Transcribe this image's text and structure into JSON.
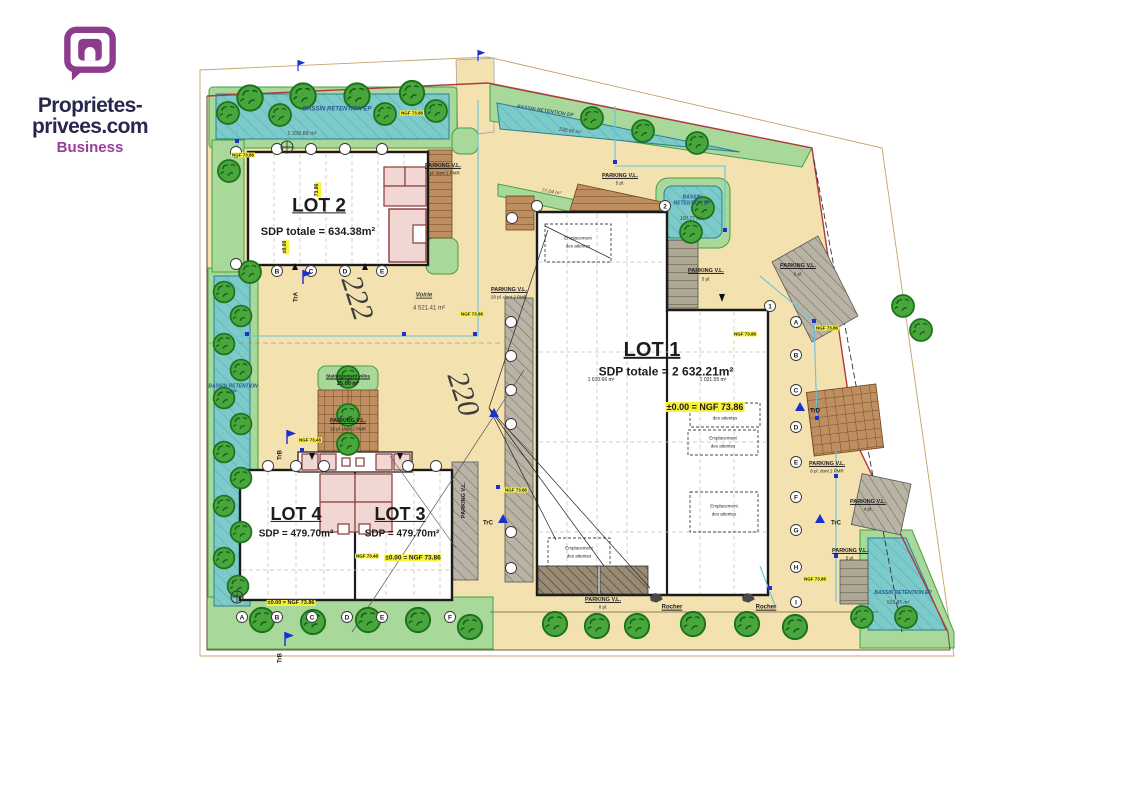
{
  "logo": {
    "line1": "Proprietes-",
    "line2": "privees.com",
    "line3": "Business"
  },
  "site": {
    "lot1_title": "LOT 1",
    "lot1_sdp": "SDP totale = 2 632.21m²",
    "lot1_area_left": "1 610.66 m²",
    "lot1_area_right": "1 021.55 m²",
    "lot2_title": "LOT 2",
    "lot2_sdp": "SDP totale = 634.38m²",
    "lot3_title": "LOT 3",
    "lot3_sdp": "SDP = 479.70m²",
    "lot4_title": "LOT 4",
    "lot4_sdp": "SDP = 479.70m²",
    "voirie_label": "Voirie",
    "voirie_area": "4 521.41 m²",
    "velo_label": "Stationnement vélos",
    "velo_area": "25.00 m²",
    "green_area": "77.04 m²",
    "rocher": "Rocher"
  },
  "bassins": [
    {
      "label": "BASSIN RETENTION EP",
      "area": "1 328.89 m²"
    },
    {
      "label": "BASSIN RETENTION EP",
      "area": "238.66 m²"
    },
    {
      "label": "BASSIN RETENTION EP",
      "area": "100.77 m²"
    },
    {
      "label": "BASSIN RETENTION EP",
      "area": ""
    },
    {
      "label": "BASSIN RETENTION EP",
      "area": "519.85 m²"
    }
  ],
  "parkings": [
    {
      "label": "PARKING V.L.",
      "detail": "7 pl. dont 1 PMR"
    },
    {
      "label": "PARKING V.L.",
      "detail": "5 pl."
    },
    {
      "label": "PARKING V.L.",
      "detail": "20 pl. dont 2 PMR"
    },
    {
      "label": "PARKING V.L.",
      "detail": "10 pl. dont 2 PMR"
    },
    {
      "label": "PARKING V.L.",
      "detail": "5 pl."
    },
    {
      "label": "PARKING V.L.",
      "detail": "6 pl."
    },
    {
      "label": "PARKING V.L.",
      "detail": "8 pl. dont 2 PMR"
    },
    {
      "label": "PARKING V.L.",
      "detail": "4 pl."
    },
    {
      "label": "PARKING V.L.",
      "detail": "5 pl."
    },
    {
      "label": "PARKING V.L.",
      "detail": "8 pl."
    },
    {
      "label": "PARKING V.L.",
      "detail": ""
    }
  ],
  "emplacement": {
    "line1": "Emplacement",
    "line2": "des attentes"
  },
  "levels": {
    "zero_ngf": "±0.00 = NGF 73.86",
    "ngf": "NGF 73.86",
    "ngf_alt": "NGF 73.48",
    "level_7386": "73.86",
    "level_zero": "±0.00"
  },
  "flags": {
    "trA": "TrA",
    "trB": "TrB",
    "trC": "TrC",
    "trD": "TrD"
  },
  "roads": {
    "n222": "222",
    "n220": "220"
  },
  "grid": {
    "letters": [
      "A",
      "B",
      "C",
      "D",
      "E",
      "F",
      "G",
      "H",
      "I"
    ],
    "numbers": [
      "1",
      "2"
    ]
  },
  "colors": {
    "ground": "#f3e1af",
    "water": "#7ccbca",
    "green": "#a9d89b",
    "boundary": "#b5373b",
    "highlight": "#f8f23c",
    "brand": "#9a3d9a",
    "flag_blue": "#1a2fd0"
  }
}
